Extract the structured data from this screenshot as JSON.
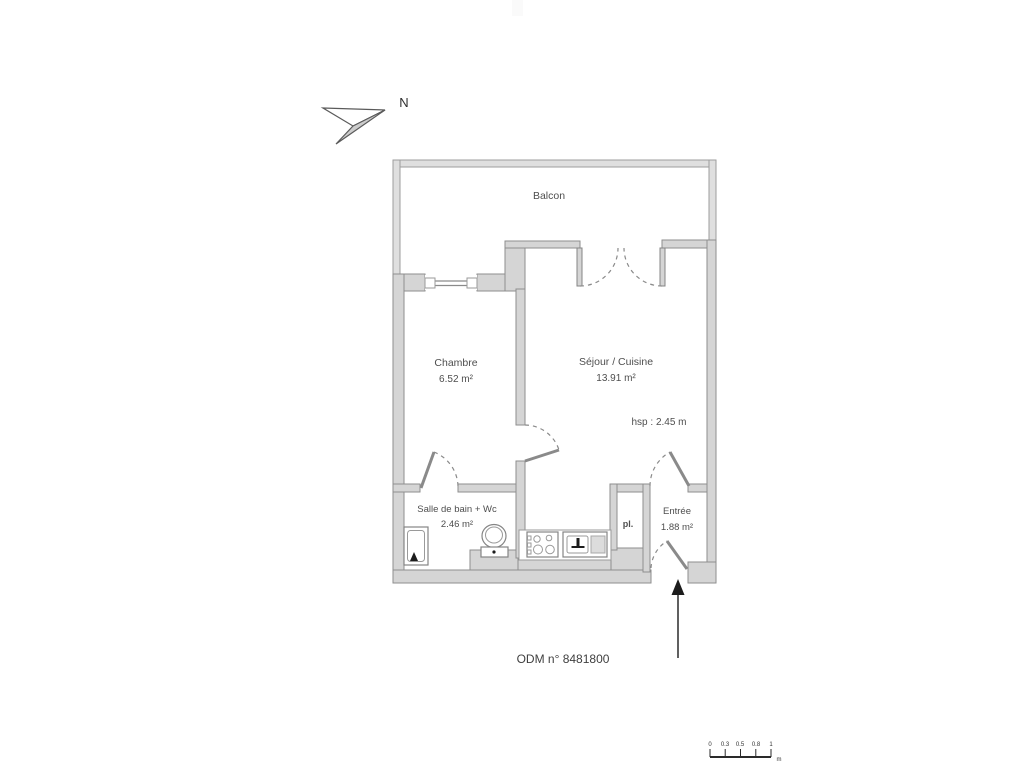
{
  "plan": {
    "north_label": "N",
    "rooms": {
      "balcon": {
        "name": "Balcon"
      },
      "chambre": {
        "name": "Chambre",
        "area": "6.52 m²"
      },
      "sejour": {
        "name": "Séjour / Cuisine",
        "area": "13.91 m²",
        "ceiling_height": "hsp : 2.45 m"
      },
      "salle_de_bain": {
        "name": "Salle de bain + Wc",
        "area": "2.46 m²"
      },
      "entree": {
        "name": "Entrée",
        "area": "1.88 m²"
      },
      "placard": {
        "label": "pl."
      }
    },
    "reference": "ODM n° 8481800",
    "scale_bar": {
      "labels": [
        "0",
        "0.3",
        "0.5",
        "0.8",
        "1"
      ],
      "unit": "m"
    },
    "colors": {
      "wall_fill": "#d5d5d5",
      "wall_stroke": "#8e8e8e",
      "railing_fill": "#dfdfdf",
      "line": "#8a8a8a",
      "text": "#4e4e4e",
      "background": "#ffffff"
    }
  }
}
